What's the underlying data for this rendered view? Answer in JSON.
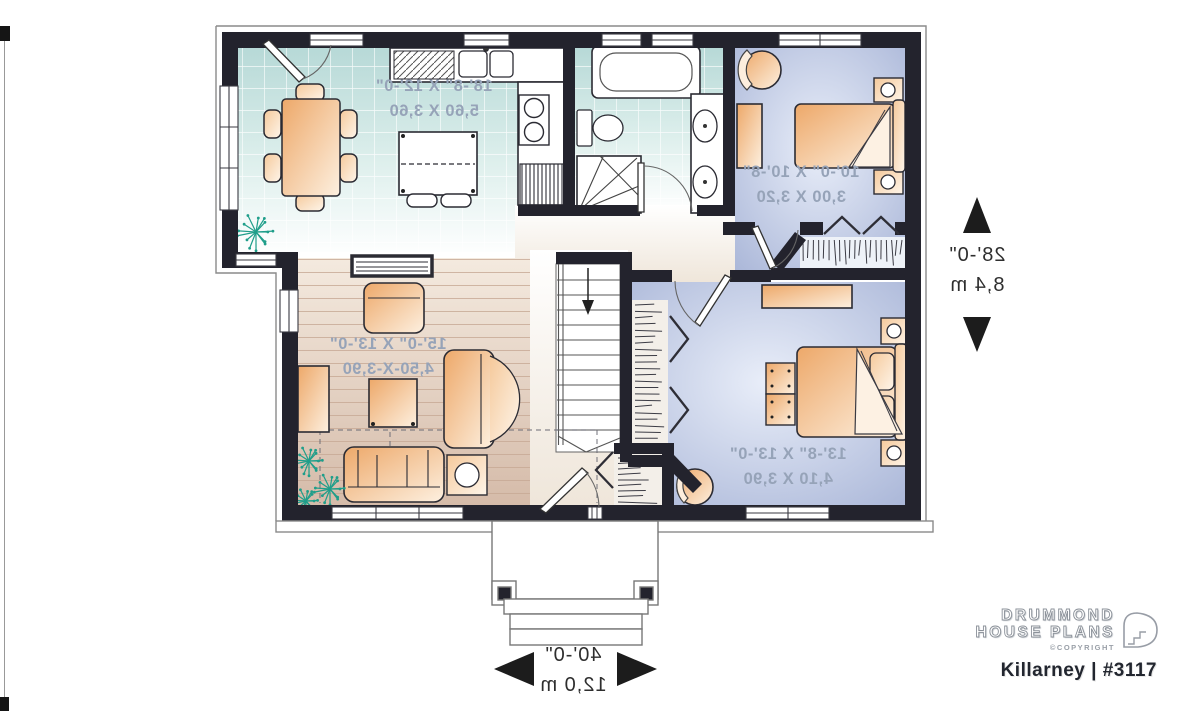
{
  "branding": {
    "name_line1": "DRUMMOND",
    "name_line2": "HOUSE PLANS",
    "copyright": "©COPYRIGHT",
    "plan_title": "Killarney | #3117"
  },
  "plan": {
    "overall": {
      "width_ft": "40'-0\"",
      "width_m": "12,0 m",
      "depth_ft": "28'-0\"",
      "depth_m": "8,4 m"
    },
    "rooms": {
      "kitchen_dining": {
        "dim_ft": "18'-8\" X 12'-0\"",
        "dim_m": "5,60 X 3,60"
      },
      "living_room": {
        "dim_ft": "15'-0\" X 13'-0\"",
        "dim_m": "4,50-X-3,90"
      },
      "bedroom_upper": {
        "dim_ft": "10'-0\" X 10'-8\"",
        "dim_m": "3,00 X 3,20"
      },
      "bedroom_lower": {
        "dim_ft": "13'-8\" X 13'-0\"",
        "dim_m": "4,10 X 3,90"
      }
    }
  },
  "colors": {
    "wall": "#23232d",
    "tile_floor": "#b7d9d7",
    "wood_floor": "#d8bfae",
    "bedroom_floor": "#a6b3d6",
    "furniture": "#eda869",
    "plant": "#1f9e8a",
    "room_label_text": "#96a3b8",
    "dimension_text": "#2e2e2e"
  }
}
